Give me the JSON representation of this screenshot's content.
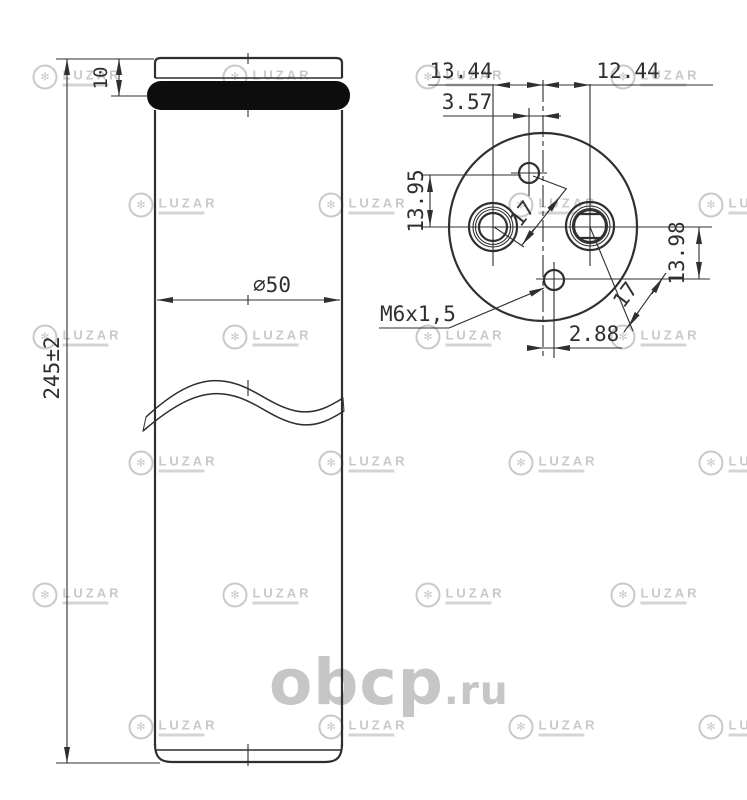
{
  "drawing": {
    "side_view": {
      "dims": {
        "cap_height": "10",
        "diameter": "⌀50",
        "total_height": "245±2"
      }
    },
    "top_view": {
      "dims": {
        "left_hole_x": "13.44",
        "right_hole_x": "12.44",
        "top_hole_x": "3.57",
        "top_hole_y": "13.95",
        "bottom_hole_y": "13.98",
        "pitch_top": "17",
        "pitch_bottom": "17",
        "bottom_hole_x": "2.88"
      },
      "thread_label": "M6x1,5"
    }
  },
  "watermarks": {
    "site_name": "obcp",
    "site_tld": ".ru",
    "brand": "LUZAR"
  },
  "colors": {
    "line": "#2f2f2f",
    "site_watermark": "#c6c6c6",
    "brand_watermark": "#c9c9c9",
    "seal_band": "#0d0d0d"
  }
}
